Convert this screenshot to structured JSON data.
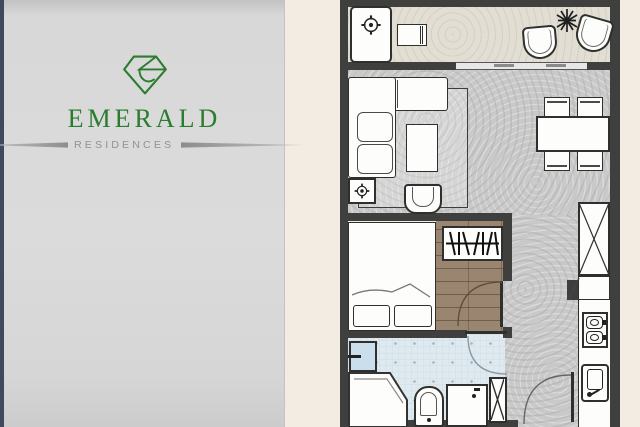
{
  "brand": {
    "name": "EMERALD",
    "tagline": "RESIDENCES",
    "name_color": "#2a7c2e",
    "diamond_color": "#2a7c2e",
    "tagline_color": "#8f9296"
  },
  "palette": {
    "accent_strip": "#3e4a5e",
    "panel_bg": "#d9d9d9",
    "plan_bg": "#f3ece3",
    "wall": "#3f3f3d",
    "balcony_floor": "#e2ded3",
    "living_floor": "#c9c9c9",
    "wood_floor": "#9a8570",
    "bathroom_floor": "#dfeaf0",
    "furniture_fill": "#fdfdfb",
    "furniture_line": "#2f2f2d"
  },
  "floorplan": {
    "rooms": [
      "balcony",
      "living-dining",
      "bedroom",
      "bathroom",
      "kitchen",
      "entry"
    ],
    "elements": [
      "ac-unit",
      "side-table",
      "balcony-chair",
      "plant",
      "sofa",
      "rug",
      "coffee-table",
      "armchair",
      "floor-ac-unit",
      "dining-table",
      "dining-chair",
      "sliding-door",
      "bed",
      "pillow",
      "hanger-rack",
      "wardrobe",
      "kitchen-counter",
      "stove",
      "kitchen-sink",
      "shower-head",
      "shower-tray",
      "toilet",
      "vanity-sink",
      "shaft",
      "bedroom-door",
      "bathroom-door",
      "entry-door"
    ]
  }
}
